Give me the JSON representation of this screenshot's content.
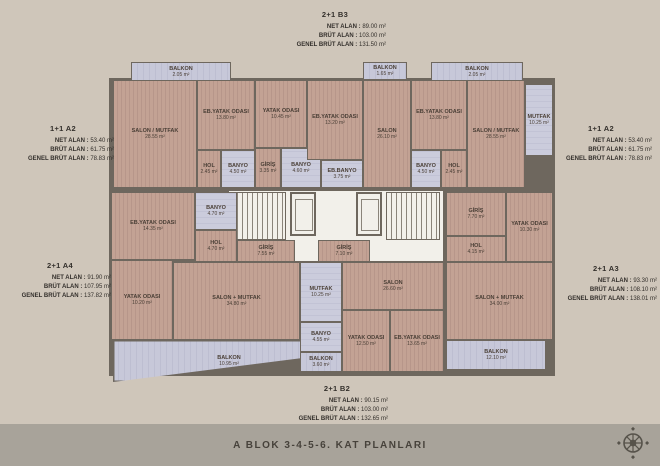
{
  "title": "A BLOK  3-4-5-6. KAT PLANLARI",
  "colors": {
    "background": "#cfc6ba",
    "bottom_strip": "#a8a39a",
    "wall": "#6e675e",
    "wood_floor": "#c3a294",
    "balcony_floor": "#c7c8d9",
    "core_floor": "#f2f0ea",
    "text": "#332f2b"
  },
  "fields": {
    "net": "NET ALAN :",
    "brut": "BRÜT ALAN :",
    "genel": "GENEL BRÜT ALAN :"
  },
  "apartments": [
    {
      "name": "2+1 B3",
      "net": "89.00 m²",
      "brut": "103.00 m²",
      "genel": "131.50 m²",
      "x": 335,
      "y": 10
    },
    {
      "name": "1+1 A2",
      "net": "53.40 m²",
      "brut": "61.75 m²",
      "genel": "78.83 m²",
      "x": 63,
      "y": 124
    },
    {
      "name": "1+1 A2",
      "net": "53.40 m²",
      "brut": "61.75 m²",
      "genel": "78.83 m²",
      "x": 601,
      "y": 124
    },
    {
      "name": "2+1 A4",
      "net": "91.90 m²",
      "brut": "107.95 m²",
      "genel": "137.82 m²",
      "x": 60,
      "y": 261
    },
    {
      "name": "2+1 A3",
      "net": "93.30 m²",
      "brut": "108.10 m²",
      "genel": "138.01 m²",
      "x": 606,
      "y": 264
    },
    {
      "name": "2+1 B2",
      "net": "90.15 m²",
      "brut": "103.00 m²",
      "genel": "132.65 m²",
      "x": 337,
      "y": 384
    }
  ],
  "floorplan": {
    "core": [
      {
        "type": "corridor",
        "x": 228,
        "y": 190,
        "w": 216,
        "h": 72
      },
      {
        "type": "stair",
        "x": 232,
        "y": 192,
        "w": 54,
        "h": 48
      },
      {
        "type": "elevator",
        "x": 290,
        "y": 192,
        "w": 26,
        "h": 44
      },
      {
        "type": "elevator",
        "x": 356,
        "y": 192,
        "w": 26,
        "h": 44
      },
      {
        "type": "stair",
        "x": 386,
        "y": 192,
        "w": 54,
        "h": 48
      }
    ],
    "rooms": [
      {
        "name": "BALKON",
        "area": "2.05 m²",
        "type": "balcony",
        "x": 131,
        "y": 62,
        "w": 100,
        "h": 20
      },
      {
        "name": "SALON / MUTFAK",
        "area": "28.55 m²",
        "type": "wood",
        "x": 113,
        "y": 80,
        "w": 84,
        "h": 108
      },
      {
        "name": "EB.YATAK ODASI",
        "area": "13.80 m²",
        "type": "wood",
        "x": 197,
        "y": 80,
        "w": 58,
        "h": 70
      },
      {
        "name": "HOL",
        "area": "2.45 m²",
        "type": "wood",
        "x": 197,
        "y": 150,
        "w": 24,
        "h": 38
      },
      {
        "name": "BANYO",
        "area": "4.50 m²",
        "type": "bath",
        "x": 221,
        "y": 150,
        "w": 34,
        "h": 38
      },
      {
        "name": "YATAK ODASI",
        "area": "10.45 m²",
        "type": "wood",
        "x": 255,
        "y": 80,
        "w": 52,
        "h": 68
      },
      {
        "name": "GİRİŞ",
        "area": "3.35 m²",
        "type": "wood",
        "x": 255,
        "y": 148,
        "w": 26,
        "h": 40
      },
      {
        "name": "BANYO",
        "area": "4.60 m²",
        "type": "bath",
        "x": 281,
        "y": 148,
        "w": 40,
        "h": 40
      },
      {
        "name": "EB.YATAK ODASI",
        "area": "13.20 m²",
        "type": "wood",
        "x": 307,
        "y": 80,
        "w": 56,
        "h": 80
      },
      {
        "name": "EB.BANYO",
        "area": "3.75 m²",
        "type": "bath",
        "x": 321,
        "y": 160,
        "w": 42,
        "h": 28
      },
      {
        "name": "BALKON",
        "area": "1.65 m²",
        "type": "balcony",
        "x": 363,
        "y": 62,
        "w": 44,
        "h": 18
      },
      {
        "name": "SALON",
        "area": "26.10 m²",
        "type": "wood",
        "x": 363,
        "y": 80,
        "w": 48,
        "h": 108
      },
      {
        "name": "BALKON",
        "area": "2.05 m²",
        "type": "balcony",
        "x": 431,
        "y": 62,
        "w": 92,
        "h": 20
      },
      {
        "name": "EB.YATAK ODASI",
        "area": "13.80 m²",
        "type": "wood",
        "x": 411,
        "y": 80,
        "w": 56,
        "h": 70
      },
      {
        "name": "BANYO",
        "area": "4.50 m²",
        "type": "bath",
        "x": 411,
        "y": 150,
        "w": 30,
        "h": 38
      },
      {
        "name": "HOL",
        "area": "2.45 m²",
        "type": "wood",
        "x": 441,
        "y": 150,
        "w": 26,
        "h": 38
      },
      {
        "name": "SALON / MUTFAK",
        "area": "28.55 m²",
        "type": "wood",
        "x": 467,
        "y": 80,
        "w": 58,
        "h": 108
      },
      {
        "name": "MUTFAK",
        "area": "10.25 m²",
        "type": "bath",
        "x": 525,
        "y": 84,
        "w": 28,
        "h": 72
      },
      {
        "name": "EB.YATAK ODASI",
        "area": "14.35 m²",
        "type": "wood",
        "x": 111,
        "y": 192,
        "w": 84,
        "h": 68
      },
      {
        "name": "BANYO",
        "area": "4.70 m²",
        "type": "bath",
        "x": 195,
        "y": 192,
        "w": 42,
        "h": 38
      },
      {
        "name": "HOL",
        "area": "4.70 m²",
        "type": "wood",
        "x": 195,
        "y": 230,
        "w": 42,
        "h": 32
      },
      {
        "name": "GİRİŞ",
        "area": "7.55 m²",
        "type": "wood",
        "x": 237,
        "y": 240,
        "w": 58,
        "h": 22
      },
      {
        "name": "GİRİŞ",
        "area": "7.10 m²",
        "type": "wood",
        "x": 318,
        "y": 240,
        "w": 52,
        "h": 22
      },
      {
        "name": "GİRİŞ",
        "area": "7.70 m²",
        "type": "wood",
        "x": 446,
        "y": 192,
        "w": 60,
        "h": 44
      },
      {
        "name": "HOL",
        "area": "4.15 m²",
        "type": "wood",
        "x": 446,
        "y": 236,
        "w": 60,
        "h": 26
      },
      {
        "name": "YATAK ODASI",
        "area": "10.30 m²",
        "type": "wood",
        "x": 506,
        "y": 192,
        "w": 47,
        "h": 70
      },
      {
        "name": "YATAK ODASI",
        "area": "10.20 m²",
        "type": "wood",
        "x": 111,
        "y": 260,
        "w": 62,
        "h": 80
      },
      {
        "name": "SALON + MUTFAK",
        "area": "34.80 m²",
        "type": "wood",
        "x": 173,
        "y": 262,
        "w": 127,
        "h": 78
      },
      {
        "name": "BALKON",
        "area": "10.95 m²",
        "type": "balcony-trapezoid",
        "x": 113,
        "y": 340,
        "w": 232,
        "h": 42
      },
      {
        "name": "MUTFAK",
        "area": "10.25 m²",
        "type": "bath",
        "x": 300,
        "y": 262,
        "w": 42,
        "h": 60
      },
      {
        "name": "BANYO",
        "area": "4.55 m²",
        "type": "bath",
        "x": 300,
        "y": 322,
        "w": 42,
        "h": 30
      },
      {
        "name": "BALKON",
        "area": "3.60 m²",
        "type": "balcony",
        "x": 300,
        "y": 352,
        "w": 42,
        "h": 20
      },
      {
        "name": "SALON",
        "area": "26.60 m²",
        "type": "wood",
        "x": 342,
        "y": 262,
        "w": 102,
        "h": 48
      },
      {
        "name": "YATAK ODASI",
        "area": "12.50 m²",
        "type": "wood",
        "x": 342,
        "y": 310,
        "w": 48,
        "h": 62
      },
      {
        "name": "EB.YATAK ODASI",
        "area": "13.65 m²",
        "type": "wood",
        "x": 390,
        "y": 310,
        "w": 54,
        "h": 62
      },
      {
        "name": "SALON + MUTFAK",
        "area": "34.00 m²",
        "type": "wood",
        "x": 446,
        "y": 262,
        "w": 107,
        "h": 78
      },
      {
        "name": "BALKON",
        "area": "12.10 m²",
        "type": "balcony",
        "x": 446,
        "y": 340,
        "w": 100,
        "h": 30
      }
    ]
  }
}
